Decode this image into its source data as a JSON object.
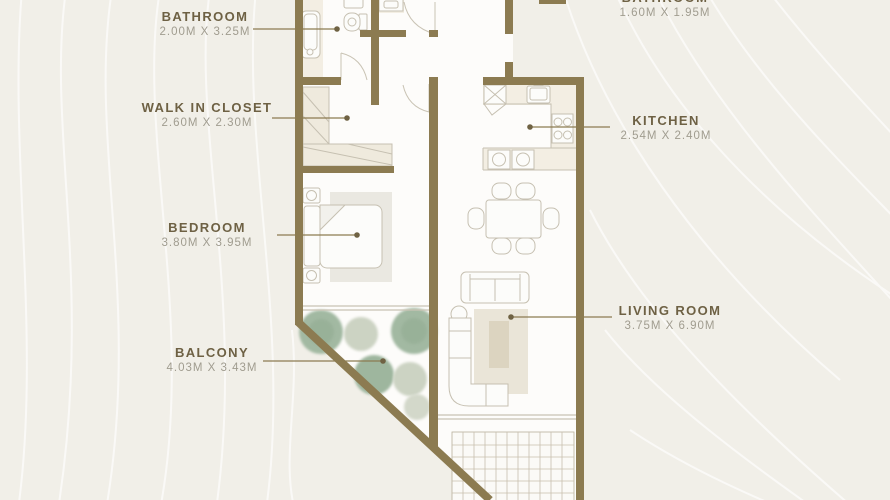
{
  "plan": {
    "type": "apartment-floor-plan",
    "colors": {
      "background": "#f1efe8",
      "wall": "#8c7b51",
      "room_name_text": "#6e6144",
      "dimension_text": "#a09c8f",
      "floor": "#fdfcfa",
      "furniture_outline": "#c6c0b1",
      "counter_tint": "#f3eee3",
      "rug": "#eae5d8",
      "coffee_table": "#dcd4c0",
      "plant_green": "#a2b9a2",
      "plant_pale": "#ccd3c3",
      "contour_line": "#ffffff"
    },
    "rooms": [
      {
        "id": "bathroom-1",
        "name": "BATHROOM",
        "dimensions": "2.00M X 3.25M",
        "furniture": [
          "bathtub",
          "toilet",
          "sink"
        ]
      },
      {
        "id": "bathroom-2",
        "name": "BATHROOM",
        "dimensions": "1.60M X 1.95M",
        "furniture": [
          "sink"
        ]
      },
      {
        "id": "walk-in-closet",
        "name": "WALK IN CLOSET",
        "dimensions": "2.60M X 2.30M",
        "furniture": [
          "wardrobe",
          "wardrobe"
        ]
      },
      {
        "id": "kitchen",
        "name": "KITCHEN",
        "dimensions": "2.54M X 2.40M",
        "furniture": [
          "refrigerator",
          "sink",
          "stove",
          "counter"
        ]
      },
      {
        "id": "bedroom",
        "name": "BEDROOM",
        "dimensions": "3.80M X 3.95M",
        "furniture": [
          "double-bed",
          "nightstand",
          "nightstand",
          "headboard"
        ]
      },
      {
        "id": "living-room",
        "name": "LIVING ROOM",
        "dimensions": "3.75M X 6.90M",
        "furniture": [
          "dining-table",
          "dining-chairs",
          "sofa",
          "sectional-sofa",
          "coffee-table",
          "rug",
          "side-table"
        ]
      },
      {
        "id": "balcony",
        "name": "BALCONY",
        "dimensions": "4.03M X 3.43M",
        "furniture": [
          "plants",
          "tiled-terrace"
        ]
      }
    ]
  }
}
